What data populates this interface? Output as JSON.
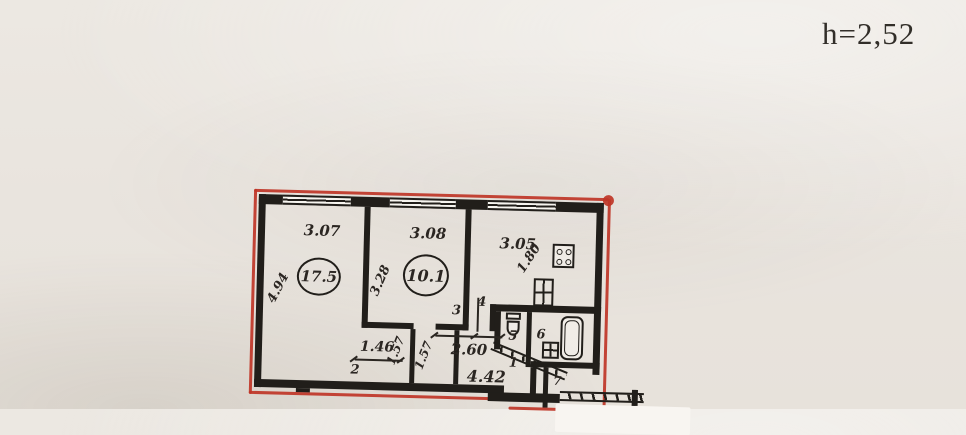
{
  "header": {
    "height_note": "h=2,52"
  },
  "plan": {
    "top_dims": {
      "left": "3.07",
      "mid": "3.08",
      "right": "3.05"
    },
    "areas": {
      "left_room": "17.5",
      "mid_room": "10.1"
    },
    "side_dims": {
      "left_vert": "4.94",
      "mid_vert": "3.28",
      "kitchen_diag": "1.80"
    },
    "lower_dims": {
      "closet_width": "1.46",
      "closet_depth_a": "1.57",
      "closet_depth_b": "1.57",
      "hall_width": "2.60",
      "hall_length": "4.42"
    },
    "room_numbers": {
      "hall": "1",
      "living": "2",
      "corridor_a": "3",
      "corridor_b": "4",
      "wc": "5",
      "bath": "6",
      "closet": "7"
    }
  },
  "colors": {
    "wall_ink": "#211e1a",
    "red_outline": "#bf3527",
    "paper": "#e9e4de"
  }
}
